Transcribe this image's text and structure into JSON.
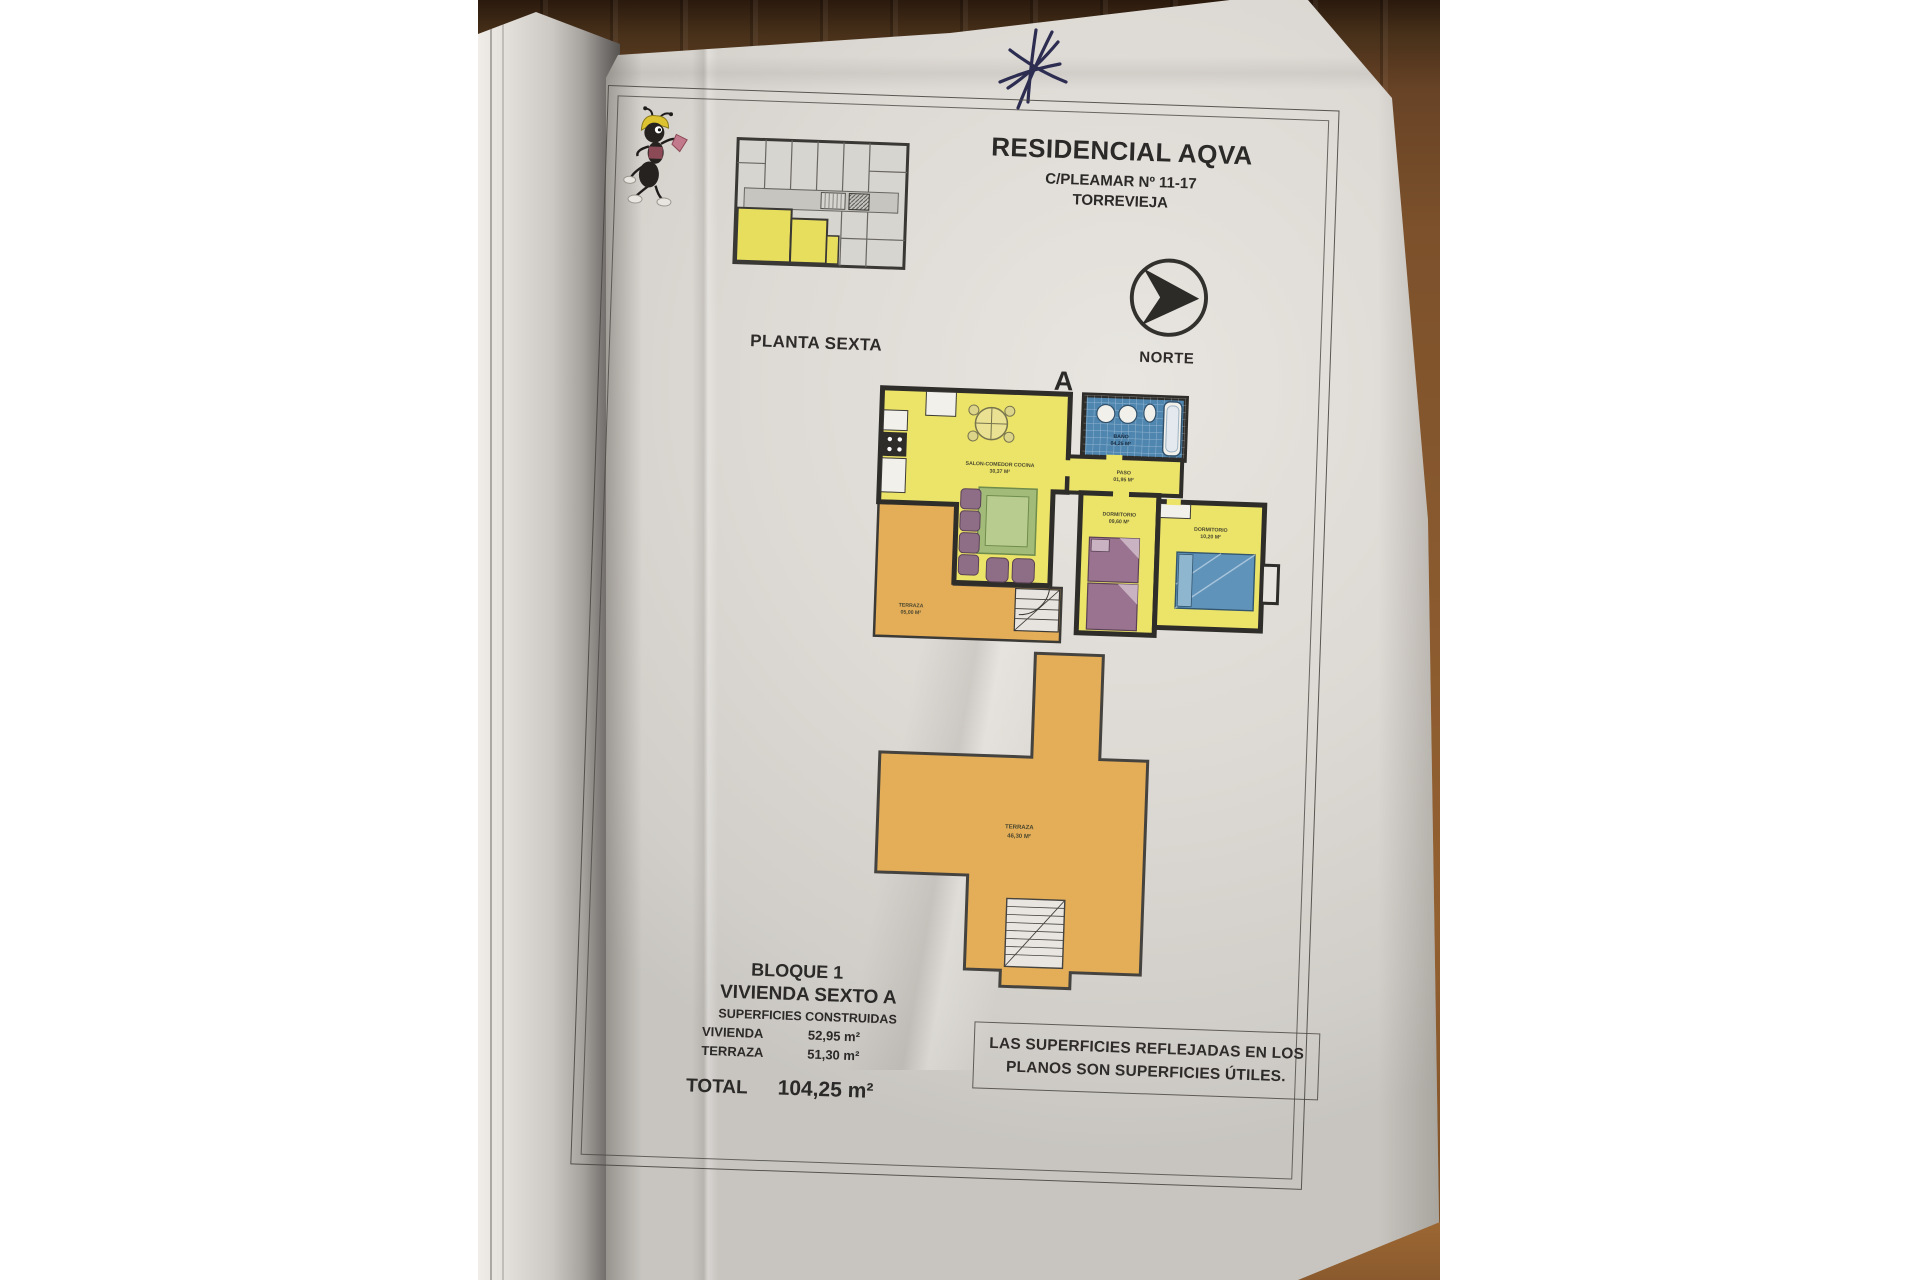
{
  "page": {
    "header": {
      "title": "RESIDENCIAL AQVA",
      "address": "C/PLEAMAR Nº 11-17",
      "city": "TORREVIEJA"
    },
    "key_plan_label": "PLANTA SEXTA",
    "north_label": "NORTE",
    "unit_letter": "A",
    "floor_plan": {
      "living": {
        "name": "SALON-COMEDOR COCINA",
        "area": "30,37 M²"
      },
      "bath": {
        "name": "BAÑO",
        "area": "04,25 M²"
      },
      "hall": {
        "name": "PASO",
        "area": "01,95 M²"
      },
      "bedroom1": {
        "name": "DORMITORIO",
        "area": "09,60 M²"
      },
      "bedroom2": {
        "name": "DORMITORIO",
        "area": "10,20 M²"
      },
      "terrace": {
        "name": "TERRAZA",
        "area": "05,00 M²"
      }
    },
    "roof_terrace": {
      "name": "TERRAZA",
      "area": "46,30 M²"
    },
    "summary": {
      "block": "BLOQUE 1",
      "unit": "VIVIENDA SEXTO A",
      "heading": "SUPERFICIES CONSTRUIDAS",
      "rows": [
        {
          "label": "VIVIENDA",
          "value": "52,95 m²"
        },
        {
          "label": "TERRAZA",
          "value": "51,30 m²"
        }
      ],
      "total_label": "TOTAL",
      "total_value": "104,25 m²"
    },
    "disclaimer_line1": "LAS SUPERFICIES REFLEJADAS EN LOS",
    "disclaimer_line2": "PLANOS SON SUPERFICIES ÚTILES."
  },
  "colors": {
    "paper": "#ddd9d4",
    "wood_brown": "#8a5a2f",
    "plan_yellow": "#ece468",
    "terrace_orange": "#e4ad58",
    "bath_blue": "#4f86b0",
    "ink_mark": "#2d2d52"
  }
}
